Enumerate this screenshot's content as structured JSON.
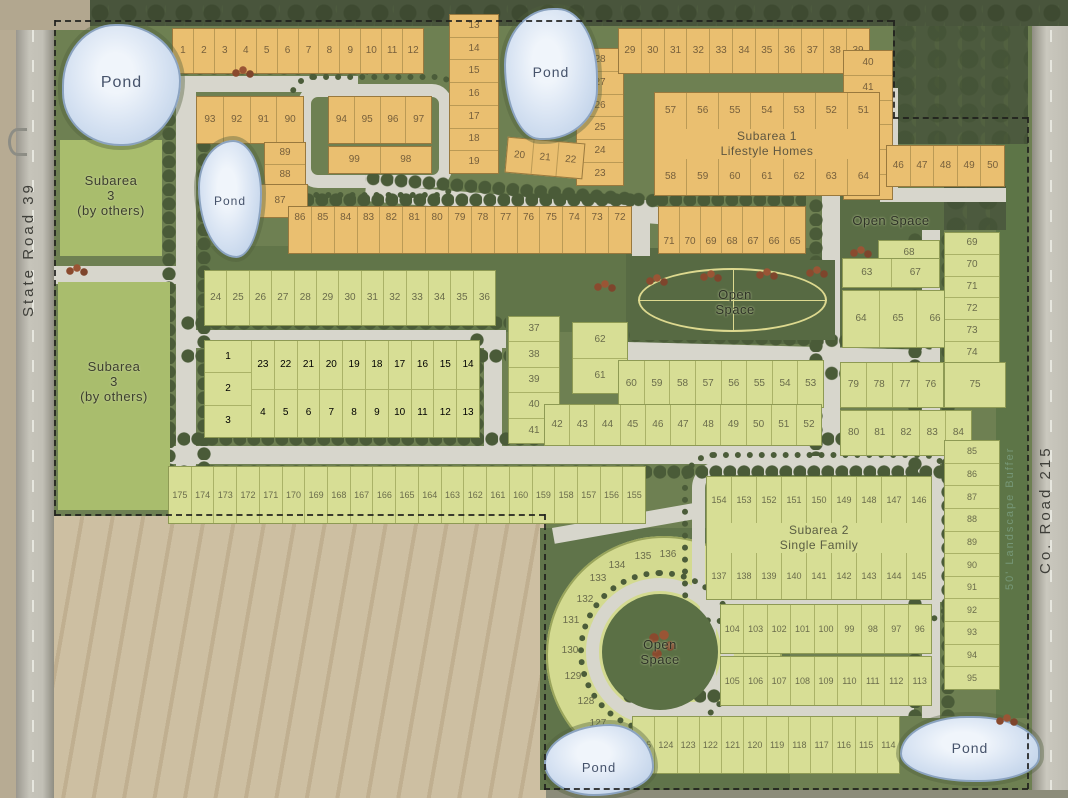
{
  "map": {
    "road_left": "State Road 39",
    "road_right": "Co. Road 215",
    "pond_label": "Pond",
    "open_space_label": "Open Space",
    "open_space_lines": {
      "l1": "Open",
      "l2": "Space"
    },
    "buffer_note": "50' Landscape Buffer",
    "subarea1": {
      "l1": "Subarea 1",
      "l2": "Lifestyle Homes"
    },
    "subarea2": {
      "l1": "Subarea 2",
      "l2": "Single Family"
    },
    "subarea3": {
      "l1": "Subarea",
      "l2": "3",
      "l3": "(by others)"
    },
    "groups": {
      "r1_12": [
        1,
        2,
        3,
        4,
        5,
        6,
        7,
        8,
        9,
        10,
        11,
        12
      ],
      "c13_19": [
        13,
        14,
        15,
        16,
        17,
        18,
        19
      ],
      "c28_23": [
        28,
        27,
        26,
        25,
        24,
        23
      ],
      "r20_22": [
        20,
        21,
        22
      ],
      "r29_39": [
        29,
        30,
        31,
        32,
        33,
        34,
        35,
        36,
        37,
        38,
        39
      ],
      "c40_45": [
        40,
        41,
        42,
        43,
        44,
        45
      ],
      "r46_50": [
        46,
        47,
        48,
        49,
        50
      ],
      "sub1_top": [
        57,
        56,
        55,
        54,
        53,
        52,
        51
      ],
      "sub1_bot": [
        58,
        59,
        60,
        61,
        62,
        63,
        64
      ],
      "r93_90": [
        93,
        92,
        91,
        90
      ],
      "r94_97": [
        94,
        95,
        96,
        97
      ],
      "c89_88": [
        89,
        88
      ],
      "lot87": [
        87
      ],
      "r99_98": [
        99,
        98
      ],
      "r86_72": [
        86,
        85,
        84,
        83,
        82,
        81,
        80,
        79,
        78,
        77,
        76,
        75,
        74,
        73,
        72
      ],
      "r71_65": [
        71,
        70,
        69,
        68,
        67,
        66,
        65
      ],
      "r24_36": [
        24,
        25,
        26,
        27,
        28,
        29,
        30,
        31,
        32,
        33,
        34,
        35,
        36
      ],
      "left_col": [
        1,
        2,
        3
      ],
      "r23_14": [
        23,
        22,
        21,
        20,
        19,
        18,
        17,
        16,
        15,
        14
      ],
      "r4_13": [
        4,
        5,
        6,
        7,
        8,
        9,
        10,
        11,
        12,
        13
      ],
      "c37_41": [
        37,
        38,
        39,
        40,
        41
      ],
      "c62_61": [
        62,
        61
      ],
      "r60_53": [
        60,
        59,
        58,
        57,
        56,
        55,
        54,
        53
      ],
      "r42_52": [
        42,
        43,
        44,
        45,
        46,
        47,
        48,
        49,
        50,
        51,
        52
      ],
      "r175_155": [
        175,
        174,
        173,
        172,
        171,
        170,
        169,
        168,
        167,
        166,
        165,
        164,
        163,
        162,
        161,
        160,
        159,
        158,
        157,
        156,
        155
      ],
      "sub2_top": [
        154,
        153,
        152,
        151,
        150,
        149,
        148,
        147,
        146
      ],
      "sub2_bot": [
        137,
        138,
        139,
        140,
        141,
        142,
        143,
        144,
        145
      ],
      "c68": [
        68
      ],
      "r63_67": [
        63,
        67
      ],
      "r64_66": [
        64,
        65,
        66
      ],
      "c69_74": [
        69,
        70,
        71,
        72,
        73,
        74
      ],
      "lot75": [
        75
      ],
      "r79_76": [
        79,
        78,
        77,
        76
      ],
      "r80_84": [
        80,
        81,
        82,
        83,
        84
      ],
      "c85_95": [
        85,
        86,
        87,
        88,
        89,
        90,
        91,
        92,
        93,
        94,
        95
      ],
      "r104_96": [
        104,
        103,
        102,
        101,
        100,
        99,
        98,
        97,
        96
      ],
      "r105_113": [
        105,
        106,
        107,
        108,
        109,
        110,
        111,
        112,
        113
      ],
      "r125_114": [
        125,
        124,
        123,
        122,
        121,
        120,
        119,
        118,
        117,
        116,
        115,
        114
      ],
      "arc": [
        136,
        135,
        134,
        133,
        132,
        131,
        130,
        129,
        128,
        127,
        126
      ]
    }
  }
}
